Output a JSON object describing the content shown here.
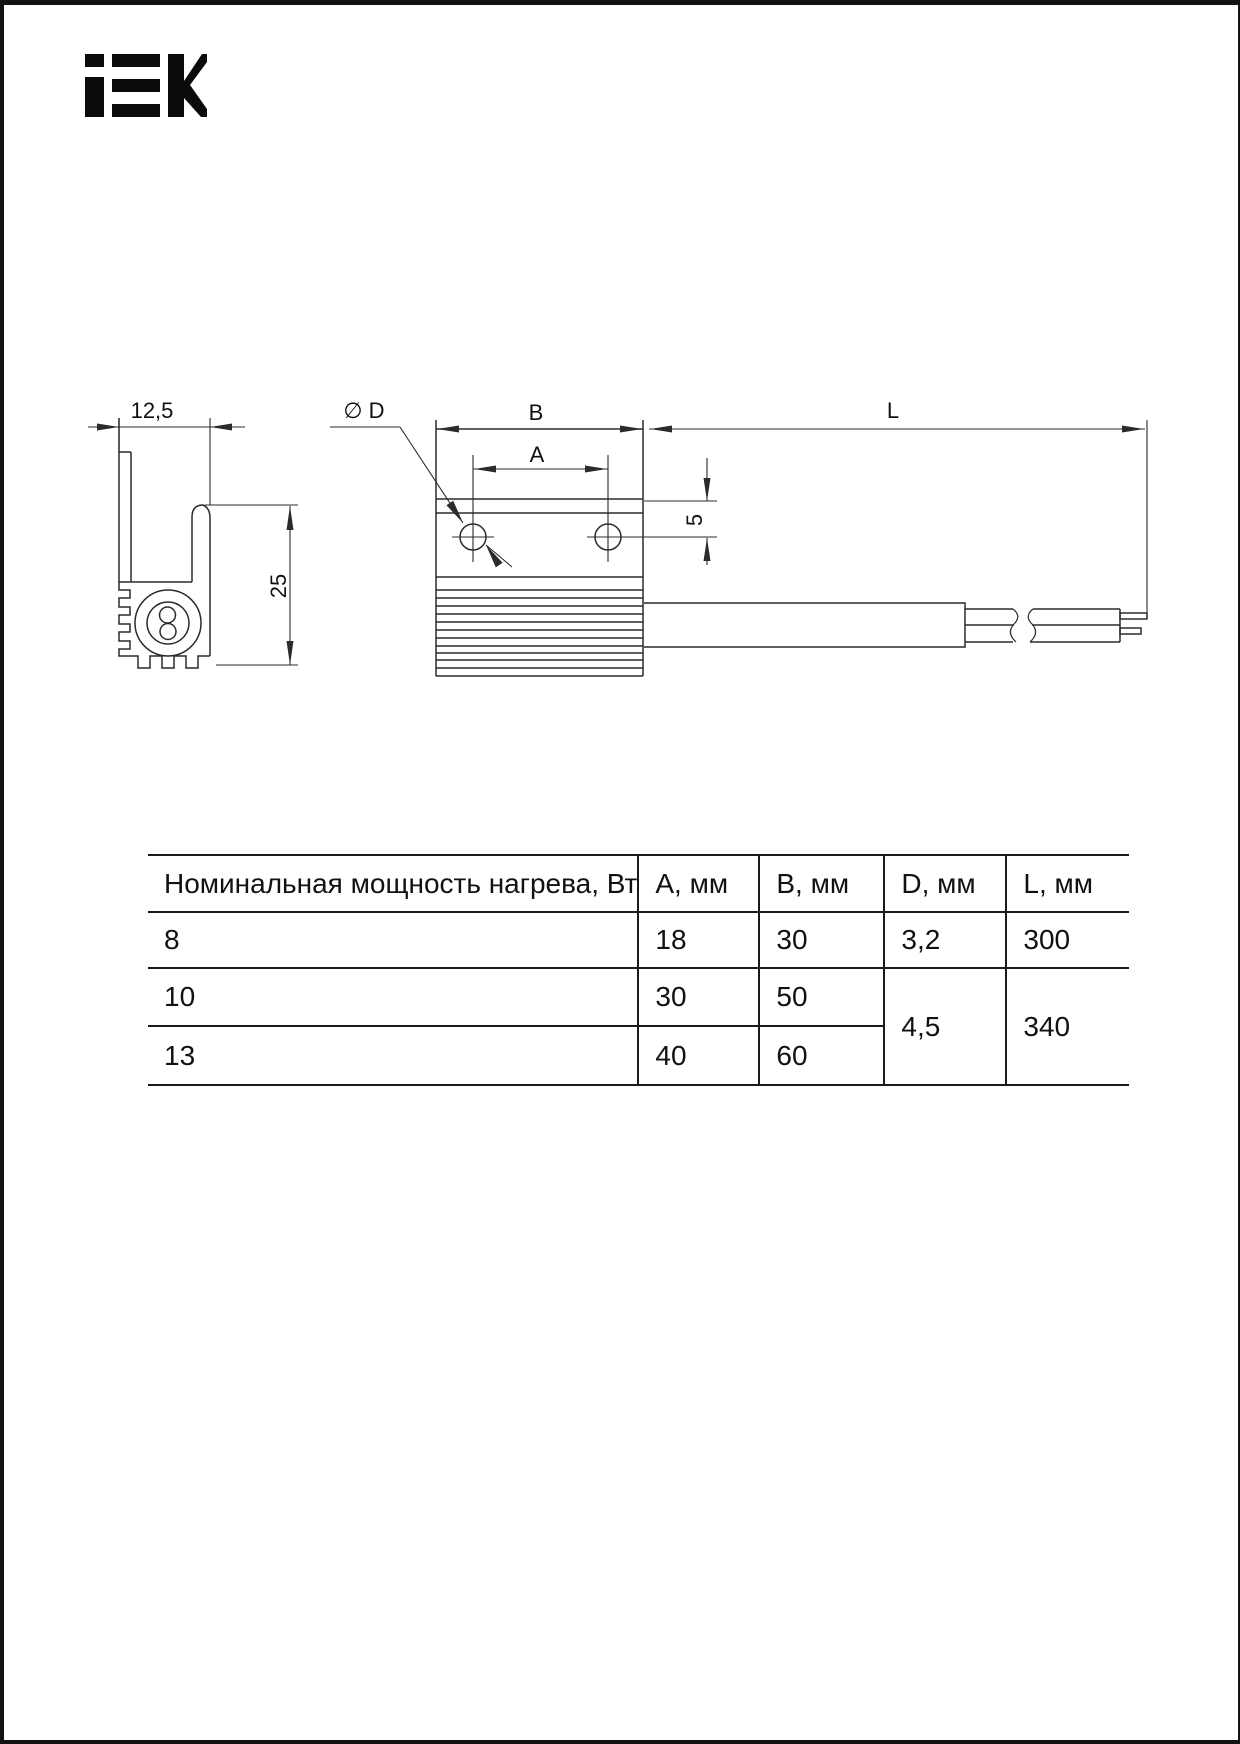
{
  "brand": {
    "name": "IEK"
  },
  "drawing": {
    "labels": {
      "width_dim": "12,5",
      "height_dim": "25",
      "diameter": "∅ D",
      "dim_b": "B",
      "dim_a": "A",
      "dim_offset": "5",
      "dim_l": "L"
    }
  },
  "table": {
    "header": [
      "Номинальная мощность нагрева, Вт",
      "А, мм",
      "В, мм",
      "D, мм",
      "L, мм"
    ],
    "rows": [
      {
        "power": "8",
        "a": "18",
        "b": "30",
        "d": "3,2",
        "l": "300"
      },
      {
        "power": "10",
        "a": "30",
        "b": "50",
        "d": "4,5",
        "l": "340"
      },
      {
        "power": "13",
        "a": "40",
        "b": "60"
      }
    ]
  }
}
